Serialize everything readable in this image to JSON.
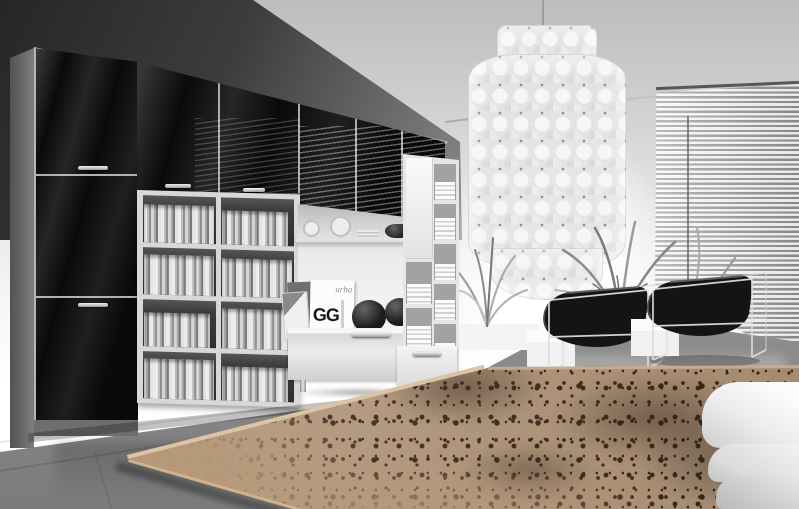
{
  "meta": {
    "scene": "Black-and-white modern living room with glossy wall unit, capiz shell chandelier, designer chairs and a color-accent beige rug with brown splatter pattern",
    "width_px": 799,
    "height_px": 509
  },
  "artwork": {
    "monogram": "GG",
    "script_word": "urba"
  },
  "palette": {
    "wall_dark": "#262626",
    "wall_mid": "#8f8f8f",
    "cabinet_black": "#0a0a0a",
    "frame_silver": "#c6c6c6",
    "shelf_frame": "#d8d8d8",
    "shelf_back": "#2e2e2e",
    "floor_light": "#c0c0c0",
    "floor_dark": "#7b7b7b",
    "blind_light": "#f6f6f6",
    "blind_dark": "#8f8f8f",
    "chair_shell": "#141414",
    "chrome": "#d6d6d6",
    "sofa_light": "#ececec",
    "sofa_shade": "#cdcdcd",
    "rug_base": "#b6997b",
    "rug_spot": "#3a2417",
    "rug_edge": "#dcc3a1"
  },
  "objects": [
    {
      "name": "wall-unit",
      "label": "Black gloss wall unit with silver frames"
    },
    {
      "name": "bookshelf",
      "label": "Open shelves filled with books"
    },
    {
      "name": "glass-cabinets",
      "label": "Upper doors reflecting window blinds"
    },
    {
      "name": "sideboard",
      "label": "White low sideboard with chrome feet"
    },
    {
      "name": "artwork-gg",
      "label": "Leaning art print with GG monogram"
    },
    {
      "name": "decor-bowls",
      "label": "Dark glass bowls and candlestick"
    },
    {
      "name": "chandelier",
      "label": "Capiz shell cascade chandelier"
    },
    {
      "name": "window-blinds",
      "label": "Horizontal venetian blinds"
    },
    {
      "name": "plants",
      "label": "Ornamental grasses in planters"
    },
    {
      "name": "lounge-chairs",
      "label": "Two black shell lounge chairs with chrome frames"
    },
    {
      "name": "area-rug",
      "label": "Beige rug with dark brown splatter pattern"
    },
    {
      "name": "sofa",
      "label": "White sofa corner"
    }
  ]
}
